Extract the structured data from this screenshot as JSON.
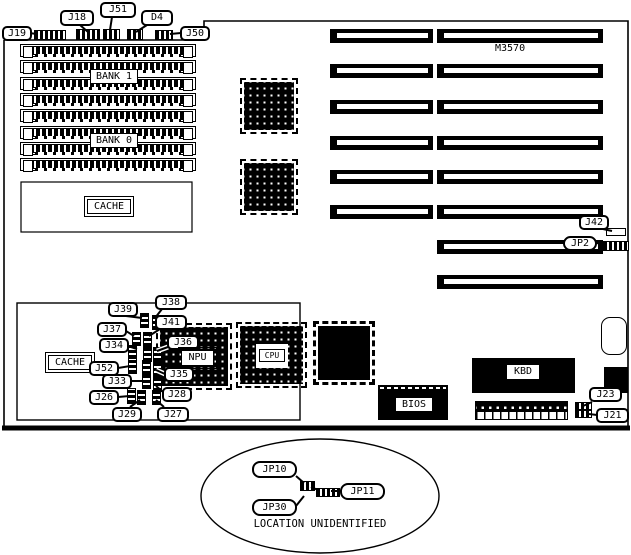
{
  "labels": {
    "j19": "J19",
    "j18": "J18",
    "j51": "J51",
    "d4": "D4",
    "j50": "J50",
    "bank1": "BANK 1",
    "bank0": "BANK 0",
    "cache_mem": "CACHE",
    "model": "M3570",
    "j42": "J42",
    "jp2": "JP2",
    "j39": "J39",
    "j38": "J38",
    "j37": "J37",
    "j41": "J41",
    "j34": "J34",
    "j36": "J36",
    "npu": "NPU",
    "cache_tag": "CACHE",
    "j52": "J52",
    "j35": "J35",
    "j33": "J33",
    "j28": "J28",
    "j26": "J26",
    "j29": "J29",
    "j27": "J27",
    "cpu": "CPU",
    "bios": "BIOS",
    "kbd": "KBD",
    "j23": "J23",
    "j21": "J21",
    "jp10": "JP10",
    "jp11": "JP11",
    "jp30": "JP30",
    "note": "LOCATION UNIDENTIFIED"
  },
  "colors": {
    "ink": "#000000",
    "paper": "#ffffff"
  }
}
